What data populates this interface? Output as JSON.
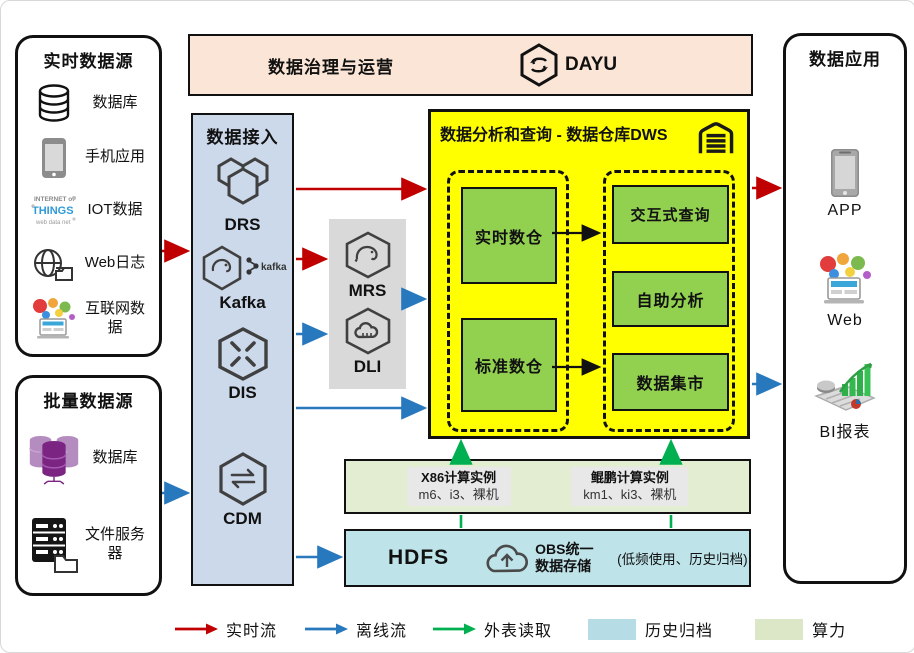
{
  "realtime_sources": {
    "title": "实时数据源",
    "items": [
      {
        "icon": "database-icon",
        "label": "数据库"
      },
      {
        "icon": "mobile-app-icon",
        "label": "手机应用"
      },
      {
        "icon": "iot-icon",
        "label": "IOT数据"
      },
      {
        "icon": "weblog-icon",
        "label": "Web日志"
      },
      {
        "icon": "internet-data-icon",
        "label": "互联网数据"
      }
    ]
  },
  "batch_sources": {
    "title": "批量数据源",
    "items": [
      {
        "icon": "batch-database-icon",
        "label": "数据库"
      },
      {
        "icon": "file-server-icon",
        "label": "文件服务器"
      }
    ]
  },
  "governance_bar": {
    "title": "数据治理与运营",
    "product": "DAYU"
  },
  "data_access": {
    "title": "数据接入",
    "services": [
      {
        "name": "DRS",
        "icon": "drs-icon"
      },
      {
        "name": "Kafka",
        "icon": "kafka-icon"
      },
      {
        "name": "DIS",
        "icon": "dis-icon"
      },
      {
        "name": "CDM",
        "icon": "cdm-icon"
      }
    ]
  },
  "processing": {
    "services": [
      {
        "name": "MRS",
        "icon": "mrs-icon"
      },
      {
        "name": "DLI",
        "icon": "dli-icon"
      }
    ]
  },
  "dws": {
    "title": "数据分析和查询 - 数据仓库DWS",
    "warehouses": [
      {
        "label": "实时数仓"
      },
      {
        "label": "标准数仓"
      }
    ],
    "services": [
      {
        "label": "交互式查询"
      },
      {
        "label": "自助分析"
      },
      {
        "label": "数据集市"
      }
    ]
  },
  "compute": {
    "instances": [
      {
        "title": "X86计算实例",
        "detail": "m6、i3、裸机"
      },
      {
        "title": "鲲鹏计算实例",
        "detail": "km1、ki3、裸机"
      }
    ]
  },
  "storage": {
    "hdfs": "HDFS",
    "obs_title": "OBS统一数据存储",
    "note": "(低频使用、历史归档)"
  },
  "data_apps": {
    "title": "数据应用",
    "items": [
      {
        "icon": "app-phone-icon",
        "label": "APP"
      },
      {
        "icon": "web-icon",
        "label": "Web"
      },
      {
        "icon": "bi-report-icon",
        "label": "BI报表"
      }
    ]
  },
  "legend": {
    "flows": [
      {
        "label": "实时流",
        "color": "#c00000"
      },
      {
        "label": "离线流",
        "color": "#2878be"
      },
      {
        "label": "外表读取",
        "color": "#00b050"
      }
    ],
    "swatches": [
      {
        "label": "历史归档",
        "color": "#b6dde6"
      },
      {
        "label": "算力",
        "color": "#dbe7c6"
      }
    ]
  },
  "colors": {
    "realtime_flow": "#c00000",
    "offline_flow": "#2878be",
    "external_read": "#00b050",
    "dws_bg": "#ffff00",
    "warehouse_green": "#92d050",
    "access_bg": "#ccd9ea",
    "governance_bg": "#fbe5d6",
    "compute_bg": "#e3edd2",
    "storage_bg": "#bee4ea",
    "processing_bg": "#d9d9d9"
  }
}
